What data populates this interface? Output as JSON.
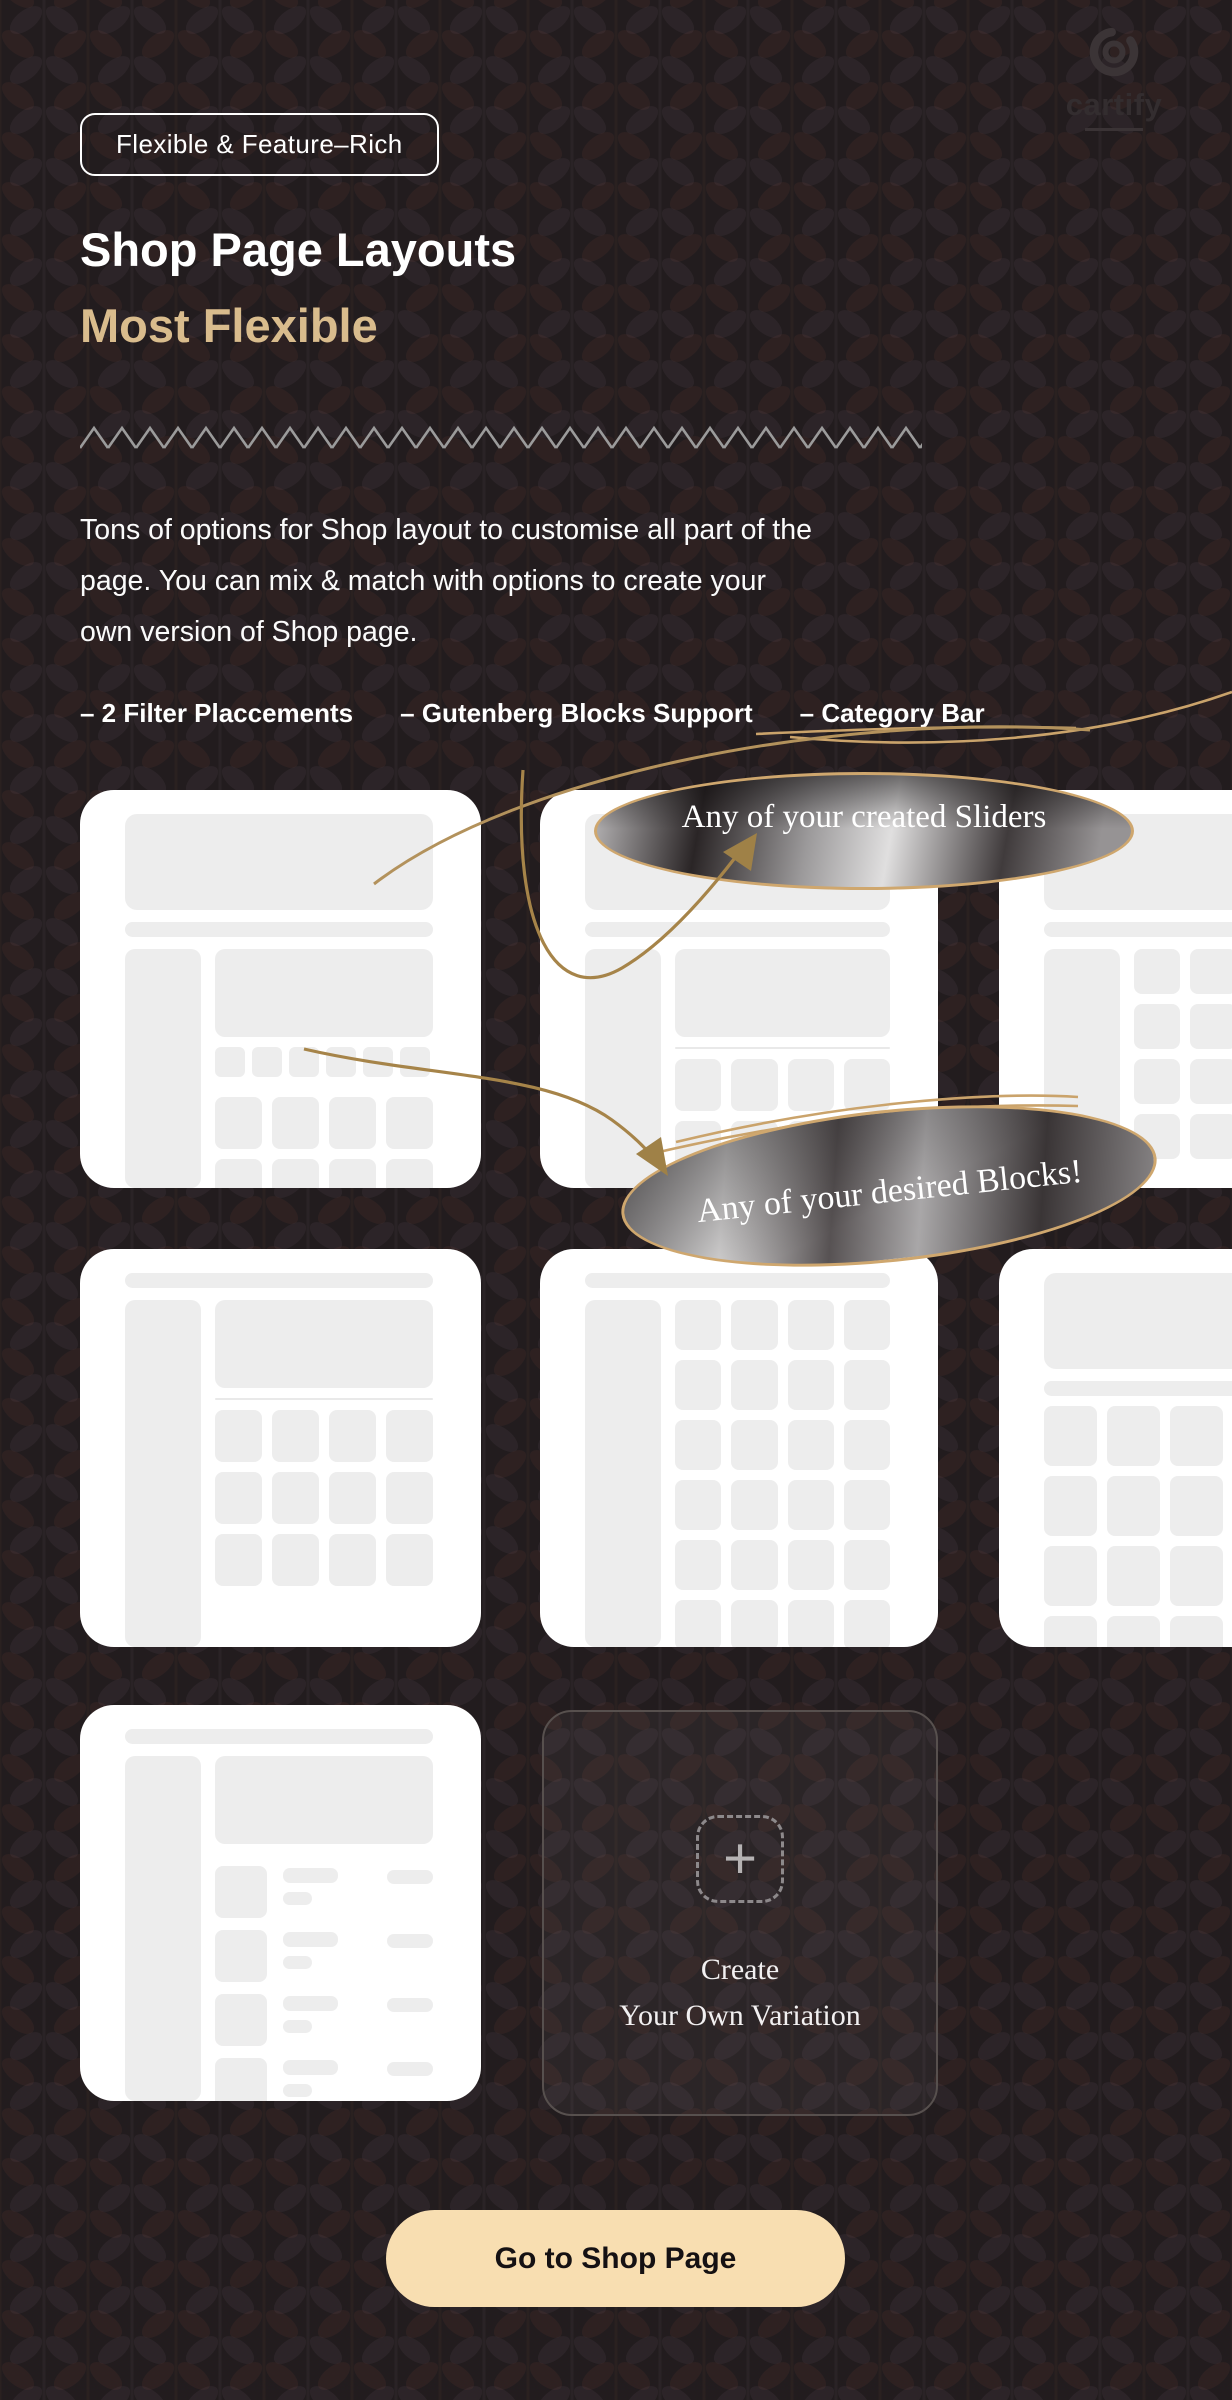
{
  "colors": {
    "background": "#221c1e",
    "accent_gold": "#d9bc8d",
    "sketch_tan": "#cfa76e",
    "arrow_tan": "#a68449",
    "button_bg": "#f8deb1",
    "card_wireframe": "#ededed",
    "zigzag_gray": "#9b9b9b"
  },
  "logo": {
    "brand": "cartify",
    "icon": "cartify-ring-icon"
  },
  "hero": {
    "badge": "Flexible & Feature–Rich",
    "title": "Shop Page Layouts",
    "subtitle": "Most Flexible",
    "description_lines": [
      "Tons of options for Shop layout to customise all part of the",
      "page. You can mix & match with options to create your",
      "own version of Shop page."
    ],
    "features": [
      "– 2 Filter Placcements",
      "– Gutenberg Blocks Support",
      "– Category Bar"
    ]
  },
  "callouts": {
    "sliders_label": "Any of your created Sliders",
    "blocks_label": "Any of your desired Blocks!"
  },
  "layout_cards": {
    "variants": [
      "banner-sidebar-filterchips-grid",
      "banner-sidebar-banner-grid",
      "banner-sidebar-grid",
      "sidebar-banner-grid",
      "sidebar-grid",
      "banner-grid-no-sidebar",
      "sidebar-banner-list"
    ]
  },
  "create_card": {
    "plus_icon": "+",
    "line1": "Create",
    "line2": "Your Own Variation"
  },
  "cta": {
    "label": "Go to Shop Page"
  }
}
